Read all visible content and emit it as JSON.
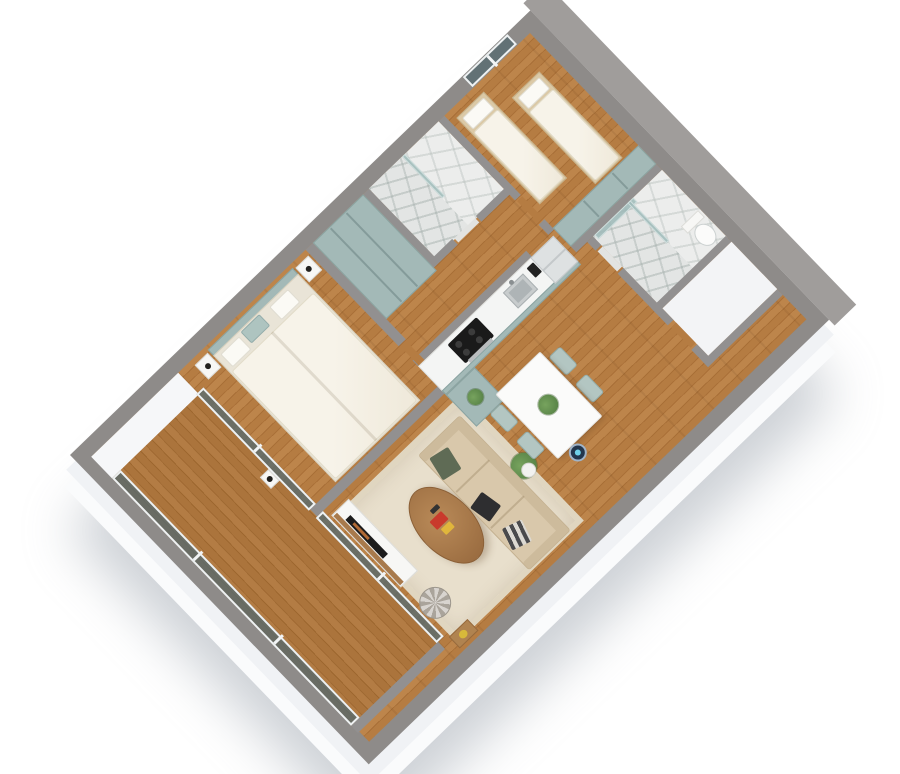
{
  "scene": {
    "type": "3d-floor-plan-render",
    "label": "3D isometric floor plan of a two-bedroom apartment",
    "background_color": "#ffffff",
    "wall_top_color": "#8e8b89",
    "wall_face_color": "#f6f7f9",
    "wood_floor_color": "#b57c42",
    "accent_sage_color": "#a3b9b7",
    "marble_color": "#ecedec",
    "glass_color": "#566a70"
  },
  "rooms": {
    "master_bedroom": {
      "label": "Master bedroom",
      "floor": "wood"
    },
    "living_room": {
      "label": "Living room",
      "floor": "wood with beige rug"
    },
    "dining_area": {
      "label": "Dining area",
      "floor": "wood"
    },
    "kitchen": {
      "label": "Kitchen",
      "floor": "wood"
    },
    "hallway": {
      "label": "Hallway with built-in wardrobe",
      "floor": "wood"
    },
    "corridor": {
      "label": "Corridor",
      "floor": "wood"
    },
    "kids_bedroom": {
      "label": "Second bedroom with two single beds",
      "floor": "wood"
    },
    "shower_bathroom": {
      "label": "Marble shower bathroom",
      "floor": "marble"
    },
    "main_bathroom": {
      "label": "Marble bathroom with toilet",
      "floor": "marble"
    },
    "storage": {
      "label": "Storage / WC",
      "floor": "white"
    },
    "balcony": {
      "label": "Balcony with glass railing",
      "floor": "wood"
    }
  },
  "furniture": {
    "double_bed": {
      "label": "Double bed with cream duvet"
    },
    "bed_pillow_white": {
      "label": "White pillow"
    },
    "bed_pillow_teal": {
      "label": "Teal pillow"
    },
    "headboard_bench": {
      "label": "Teal headboard bench"
    },
    "nightstand": {
      "label": "White nightstand"
    },
    "bedside_cup": {
      "label": "Black cup"
    },
    "hall_wardrobe": {
      "label": "Sage L-shaped hallway wardrobe"
    },
    "kids_wardrobe": {
      "label": "Sage wardrobe"
    },
    "single_bed_1": {
      "label": "Single bed 1"
    },
    "single_bed_2": {
      "label": "Single bed 2"
    },
    "bedroom_window": {
      "label": "Window"
    },
    "tv_console": {
      "label": "White TV console"
    },
    "tv": {
      "label": "Television"
    },
    "sofa": {
      "label": "Beige fabric sofa"
    },
    "pillow_green": {
      "label": "Green cushion"
    },
    "pillow_black": {
      "label": "Black cushion"
    },
    "pillow_striped": {
      "label": "Striped cushion"
    },
    "coffee_table": {
      "label": "Oval wooden coffee table"
    },
    "tray_red": {
      "label": "Red tray"
    },
    "tray_yellow": {
      "label": "Yellow book"
    },
    "rug": {
      "label": "Beige area rug"
    },
    "pouf": {
      "label": "Striped pouf"
    },
    "side_table": {
      "label": "Wooden side table"
    },
    "yellow_bowl": {
      "label": "Yellow bowl"
    },
    "dining_table": {
      "label": "White dining table"
    },
    "dining_chair": {
      "label": "Sage dining chair"
    },
    "table_plant": {
      "label": "Table plant"
    },
    "floor_plant": {
      "label": "Potted plant in white pot"
    },
    "counter_plant": {
      "label": "Plant on cabinet"
    },
    "kitchen_counter": {
      "label": "Kitchen counter with sage cabinets"
    },
    "cooktop": {
      "label": "Black cooktop"
    },
    "oven": {
      "label": "Stainless oven"
    },
    "sink": {
      "label": "Stainless sink"
    },
    "coffee_machine": {
      "label": "Black coffee machine"
    },
    "fridge": {
      "label": "Refrigerator"
    },
    "kitchen_return": {
      "label": "Sage kitchen cabinet"
    },
    "toilet": {
      "label": "Toilet"
    },
    "shower_glass": {
      "label": "Teal glass shower screen"
    },
    "robot_vacuum": {
      "label": "Robot vacuum"
    },
    "balcony_railing": {
      "label": "Glass balcony railing"
    },
    "glass_door_bedroom": {
      "label": "Sliding glass door to balcony"
    },
    "glass_door_living": {
      "label": "Living room glass wall to balcony"
    },
    "balcony_vase": {
      "label": "Black vase on sill"
    }
  }
}
